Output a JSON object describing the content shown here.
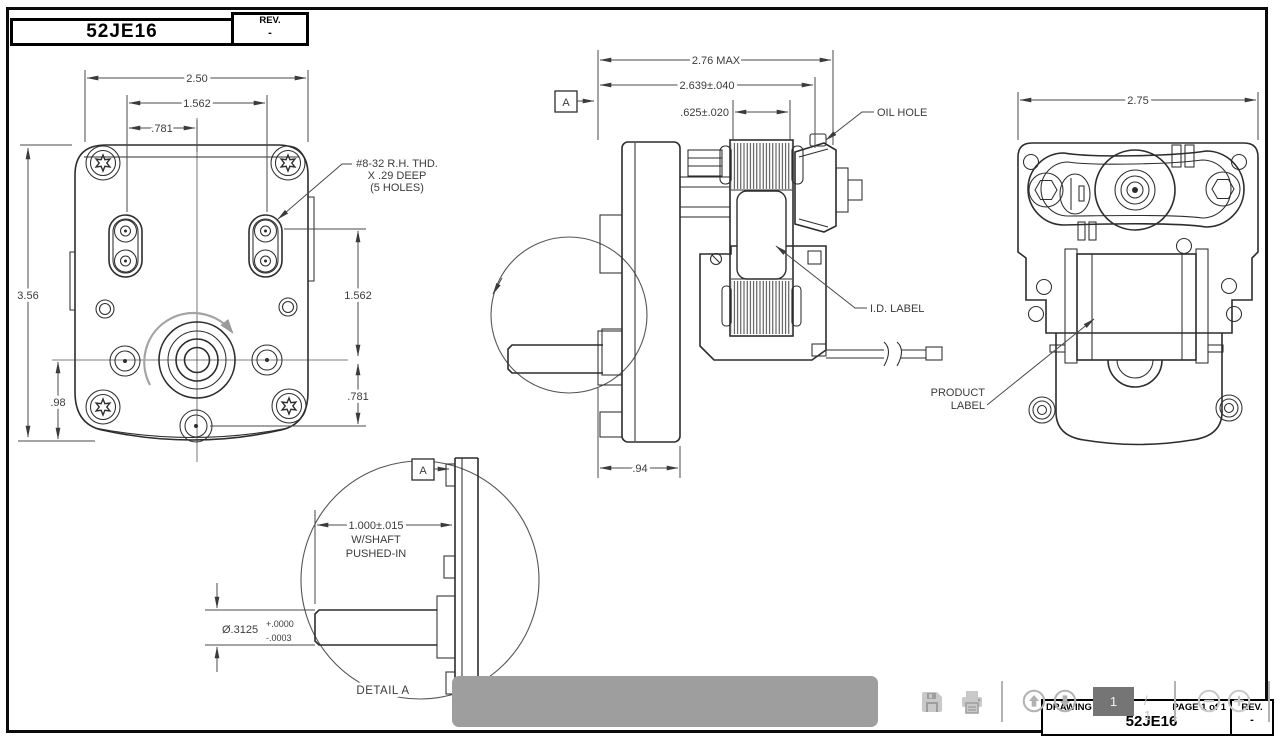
{
  "header": {
    "drawing_no": "52JE16",
    "rev_label": "REV.",
    "rev_value": "-"
  },
  "front_view": {
    "dim_width": "2.50",
    "dim_slot_span": "1.562",
    "dim_slot_offset": ".781",
    "dim_height": "3.56",
    "dim_shaft_height": ".98",
    "dim_right_upper": "1.562",
    "dim_right_lower": ".781",
    "note_line1": "#8-32 R.H. THD.",
    "note_line2": "X .29 DEEP",
    "note_line3": "(5 HOLES)"
  },
  "side_view": {
    "dim_max": "2.76 MAX",
    "dim_body": "2.639±.040",
    "dim_stator": ".625±.020",
    "dim_gearbox": ".94",
    "datum": "A",
    "label_oil_hole": "OIL HOLE",
    "label_id": "I.D. LABEL"
  },
  "rear_view": {
    "dim_width": "2.75",
    "label_line1": "PRODUCT",
    "label_line2": "LABEL"
  },
  "detail_view": {
    "datum": "A",
    "dim_len": "1.000±.015",
    "dim_len_note1": "W/SHAFT",
    "dim_len_note2": "PUSHED-IN",
    "dim_dia": "Ø.3125",
    "dim_dia_plus": "+.0000",
    "dim_dia_minus": "-.0003",
    "caption": "DETAIL A"
  },
  "toolbar": {
    "page_current": "1",
    "page_total": "/ 1",
    "icons": [
      "save-icon",
      "print-icon",
      "page-up-icon",
      "page-down-icon",
      "zoom-out-icon",
      "zoom-in-icon",
      "acrobat-icon"
    ]
  },
  "footer": {
    "drawing_no_label": "DRAWING NO.",
    "page_label": "PAGE 1 of 1",
    "drawing_no": "52JE16",
    "rev_label": "REV.",
    "rev_value": "-"
  }
}
